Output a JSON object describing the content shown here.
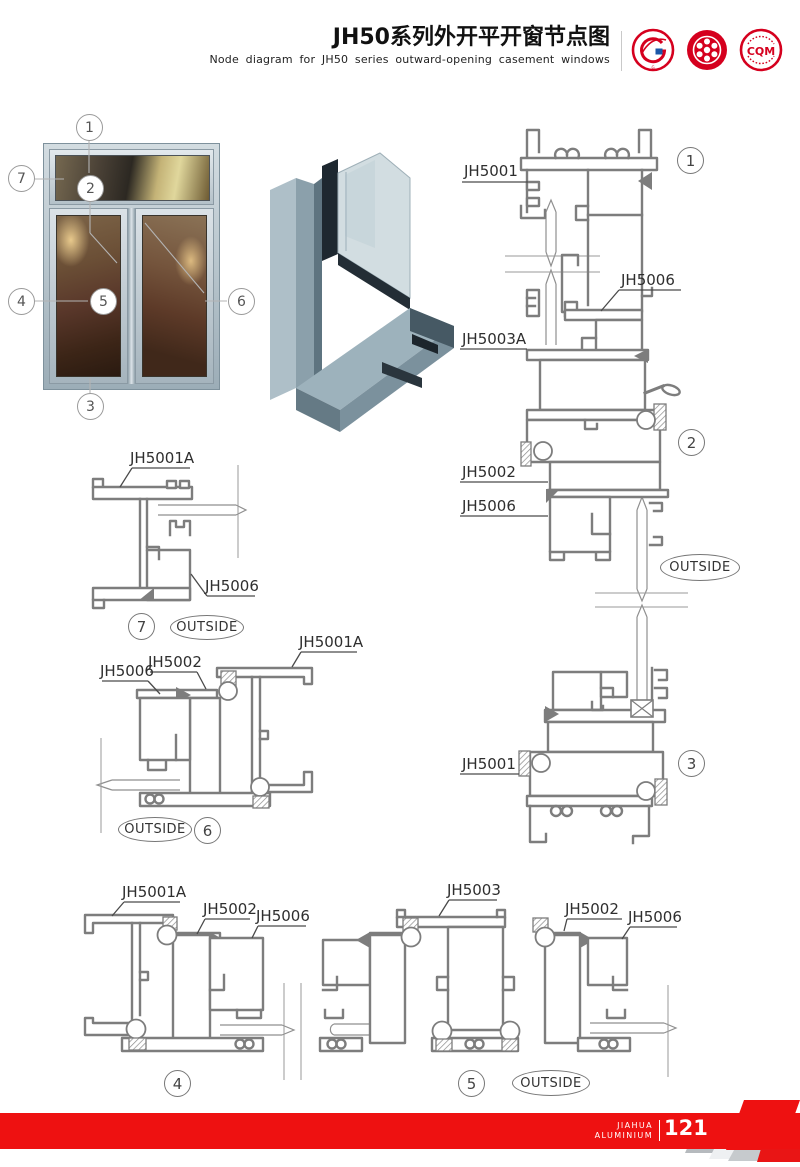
{
  "header": {
    "title_zh": "JH50系列外开平开窗节点图",
    "subtitle_en": "Node diagram for JH50 series outward-opening casement windows",
    "logos": [
      {
        "name": "gb-design-badge",
        "text": "G"
      },
      {
        "name": "quality-emblem-badge",
        "text": ""
      },
      {
        "name": "cqm-certification-badge",
        "text": "CQM"
      }
    ]
  },
  "photo": {
    "callouts": [
      "1",
      "2",
      "3",
      "4",
      "5",
      "6",
      "7"
    ]
  },
  "diagram": {
    "part_labels": [
      {
        "text": "JH5001"
      },
      {
        "text": "JH5006"
      },
      {
        "text": "JH5003A"
      },
      {
        "text": "JH5002"
      },
      {
        "text": "JH5006"
      },
      {
        "text": "JH5001"
      },
      {
        "text": "JH5001A"
      },
      {
        "text": "JH5006"
      },
      {
        "text": "JH5006"
      },
      {
        "text": "JH5002"
      },
      {
        "text": "JH5001A"
      },
      {
        "text": "JH5001A"
      },
      {
        "text": "JH5002"
      },
      {
        "text": "JH5006"
      },
      {
        "text": "JH5003"
      },
      {
        "text": "JH5002"
      },
      {
        "text": "JH5006"
      }
    ],
    "section_markers": [
      "1",
      "2",
      "3",
      "7",
      "6",
      "4",
      "5"
    ],
    "outside_labels": [
      "OUTSIDE",
      "OUTSIDE",
      "OUTSIDE",
      "OUTSIDE"
    ]
  },
  "footer": {
    "brand_top": "JIAHUA",
    "brand_bottom": "ALUMINIUM",
    "page_number": "121"
  },
  "colors": {
    "accent_red": "#ee1111",
    "logo_red": "#d5001e",
    "line_gray": "#7d7d7d",
    "frame_silver": "#bcc8d0"
  }
}
